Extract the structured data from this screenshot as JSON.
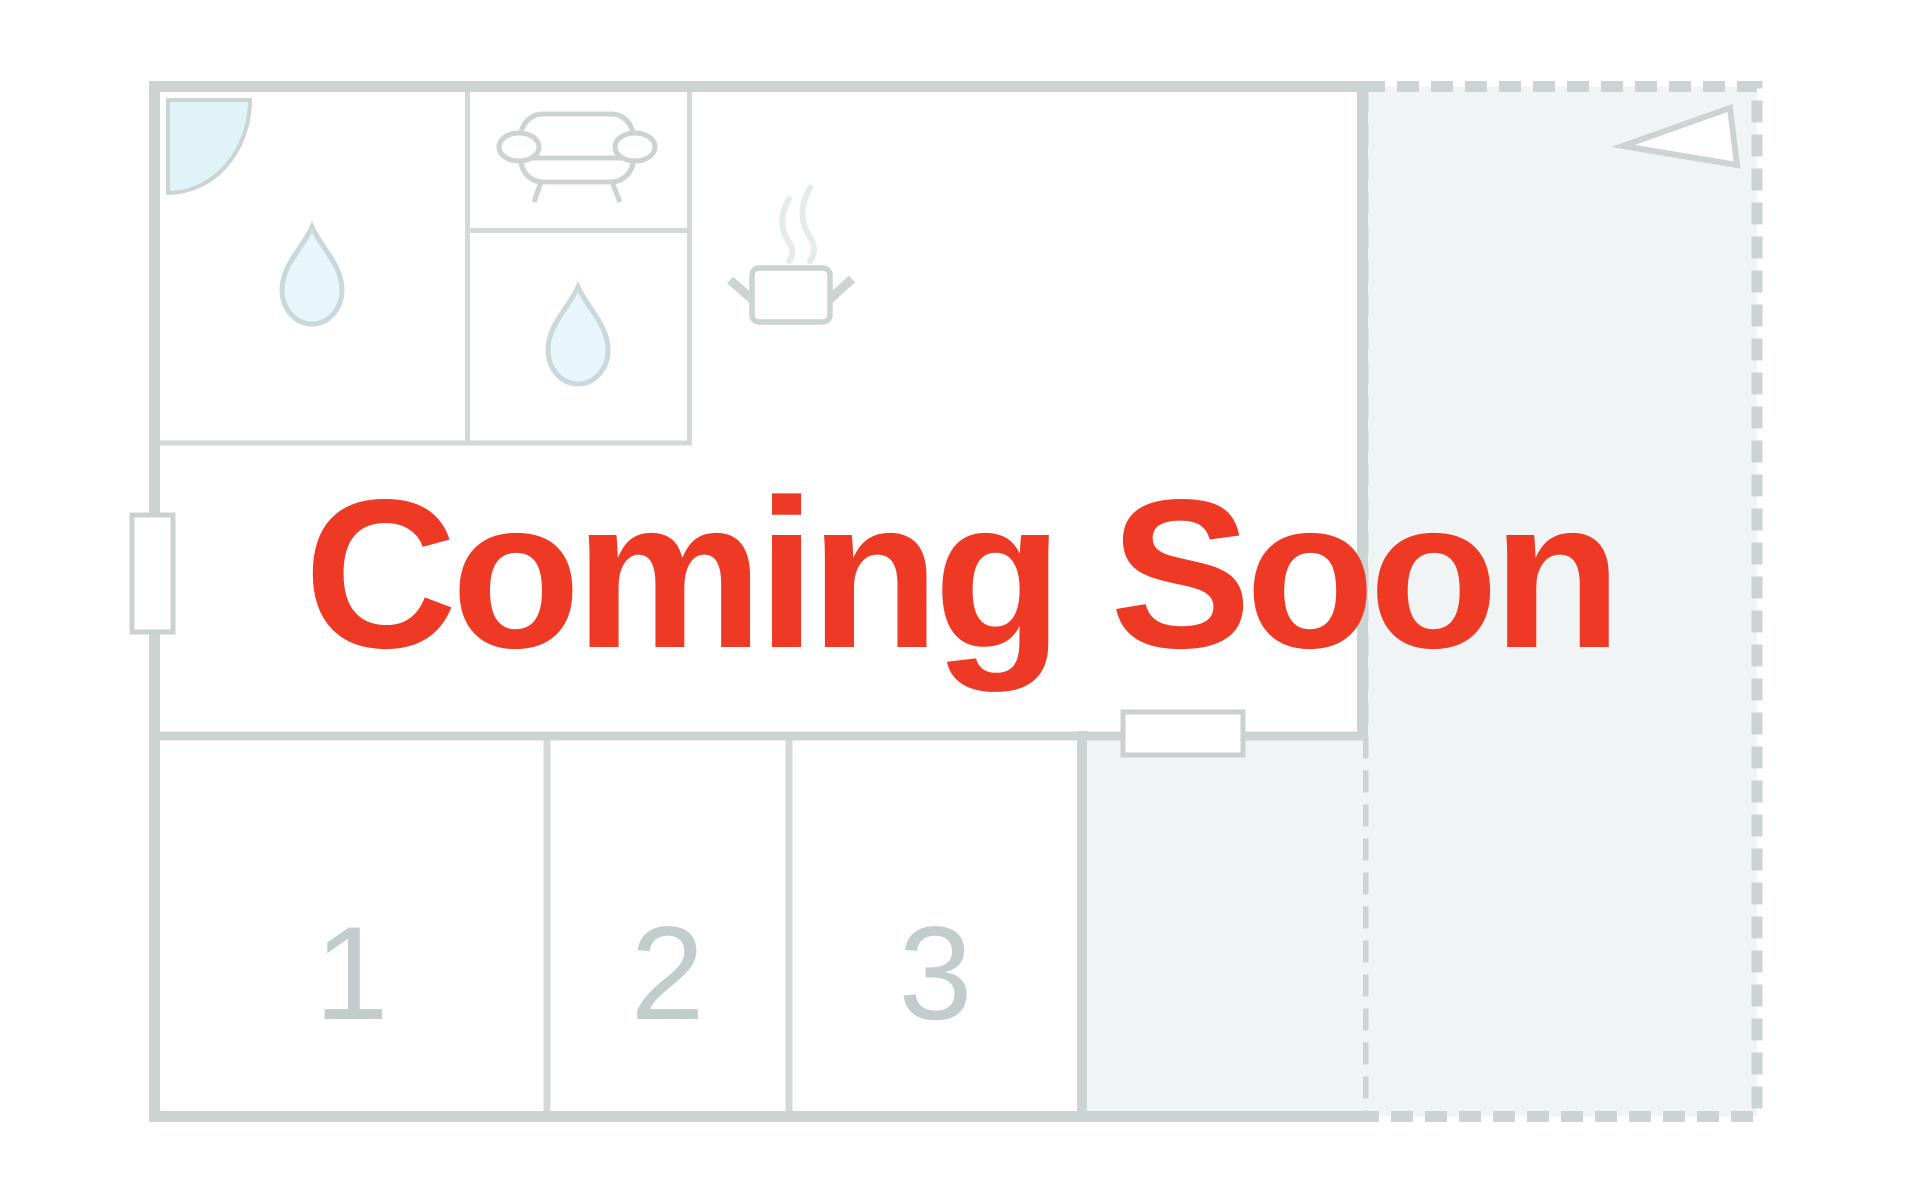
{
  "banner": {
    "text": "Coming Soon"
  },
  "rooms": [
    {
      "label": "1"
    },
    {
      "label": "2"
    },
    {
      "label": "3"
    }
  ],
  "icons": {
    "door_swing": "quarter-circle-door-arc",
    "water_drop_1": "teardrop",
    "water_drop_2": "teardrop",
    "sofa": "sofa-top-view",
    "cooking_pot": "pot-with-steam",
    "direction_flag": "triangle-flag",
    "window_left": "window-on-wall",
    "window_bottom": "window-on-wall"
  },
  "colors": {
    "background": "#ffffff",
    "wall": "#ccd4d3",
    "wall_light": "#d2d9d8",
    "area_fill": "#f1f4f5",
    "window_fill": "#ffffff",
    "window_stroke": "#c9d2d1",
    "door_fill": "#e0f3f9",
    "drop_fill": "#e8f6fb",
    "drop_stroke": "#c9d8da",
    "steam": "#e4ebeb",
    "room_number": "#c3cccc",
    "accent_red": "#ee3a25"
  }
}
